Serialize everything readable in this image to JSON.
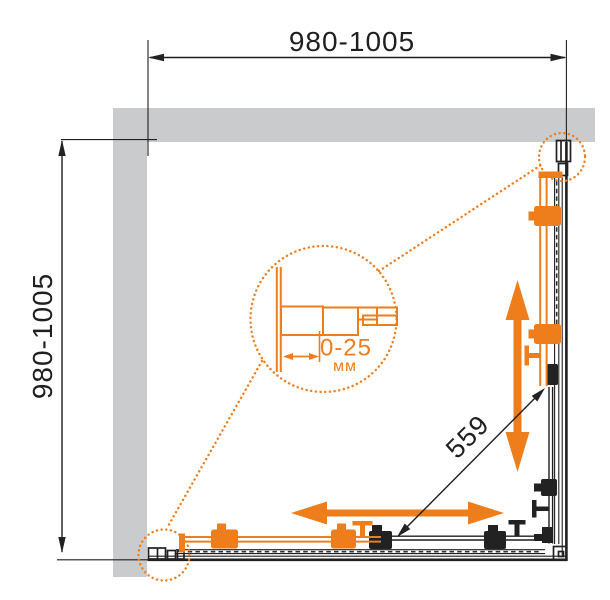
{
  "diagram": {
    "type": "shower-enclosure-dimension-drawing",
    "top_dimension": "980-1005",
    "left_dimension": "980-1005",
    "diagonal_dimension": "559",
    "detail": {
      "adjustment_range": "0-25",
      "unit": "мм"
    },
    "colors": {
      "accent_orange": "#EE7E1B",
      "wall_gray": "#C9CBCD",
      "line_black": "#1F1F1F"
    }
  }
}
